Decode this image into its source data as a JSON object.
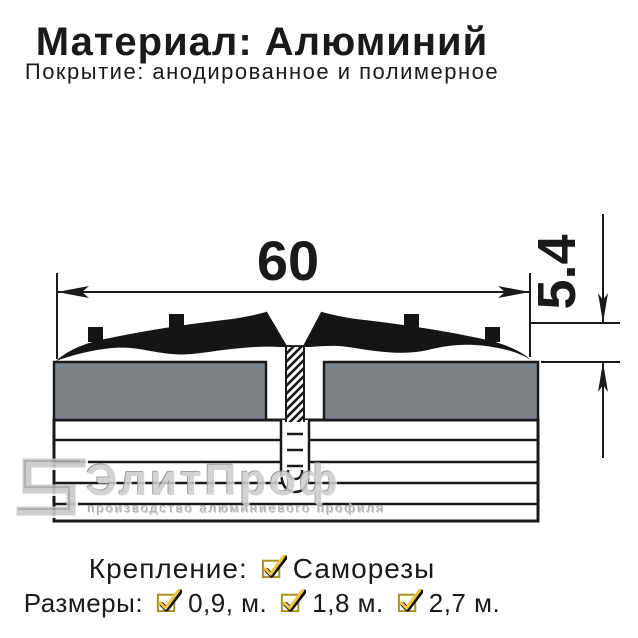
{
  "header": {
    "material_line": "Материал: Алюминий",
    "coating_line": "Покрытие: анодированное и полимерное"
  },
  "diagram": {
    "width_label": "60",
    "height_label": "5.4"
  },
  "watermark": {
    "brand": "ЭлитПроф",
    "tagline": "производство алюминиевого профиля"
  },
  "footer": {
    "fastening_label": "Крепление:",
    "fastening_value": "Саморезы",
    "sizes_label": "Размеры:",
    "sizes": [
      "0,9, м.",
      "1,8 м.",
      "2,7 м."
    ]
  },
  "colors": {
    "ink": "#1a1a1a",
    "panel_gray": "#7d8287",
    "check_gold": "#e9c63f",
    "check_border": "#a59022",
    "watermark_gray": "#cdcdcd"
  }
}
